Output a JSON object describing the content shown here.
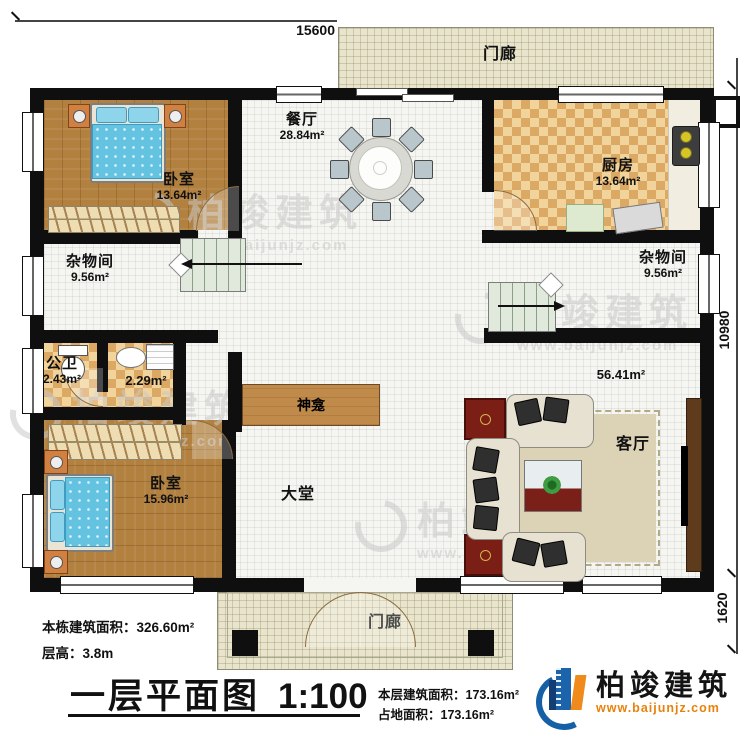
{
  "title": {
    "name": "一层平面图",
    "scale": "1:100"
  },
  "dimensions": {
    "top": "15600",
    "right_upper": "10980",
    "right_lower": "1620"
  },
  "rooms": {
    "bedroom1": {
      "label": "卧室",
      "area": "13.64m²"
    },
    "dining": {
      "label": "餐厅",
      "area": "28.84m²"
    },
    "kitchen": {
      "label": "厨房",
      "area": "13.64m²"
    },
    "storage_left": {
      "label": "杂物间",
      "area": "9.56m²"
    },
    "storage_right": {
      "label": "杂物间",
      "area": "9.56m²"
    },
    "bathroom": {
      "label": "公卫",
      "area": "2.43m²"
    },
    "washroom": {
      "area": "2.29m²"
    },
    "bedroom2": {
      "label": "卧室",
      "area": "15.96m²"
    },
    "hall": {
      "label": "大堂"
    },
    "living": {
      "label": "客厅",
      "area": "56.41m²"
    },
    "shrine": {
      "label": "神龛"
    },
    "porch_top": {
      "label": "门廊"
    },
    "porch_bottom": {
      "label": "门廊"
    }
  },
  "stats": {
    "building_area": "本栋建筑面积：326.60m²",
    "floor_height": "层高：3.8m",
    "floor_area": "本层建筑面积：173.16m²",
    "footprint_area": "占地面积：173.16m²"
  },
  "brand": {
    "name": "柏竣建筑",
    "website": "www.baijunjz.com"
  },
  "colors": {
    "wall": "#0f0f0f",
    "wood": "#b2803f",
    "checker": "#dca964",
    "accent_blue": "#1b63ab",
    "accent_orange": "#f08a1d"
  }
}
